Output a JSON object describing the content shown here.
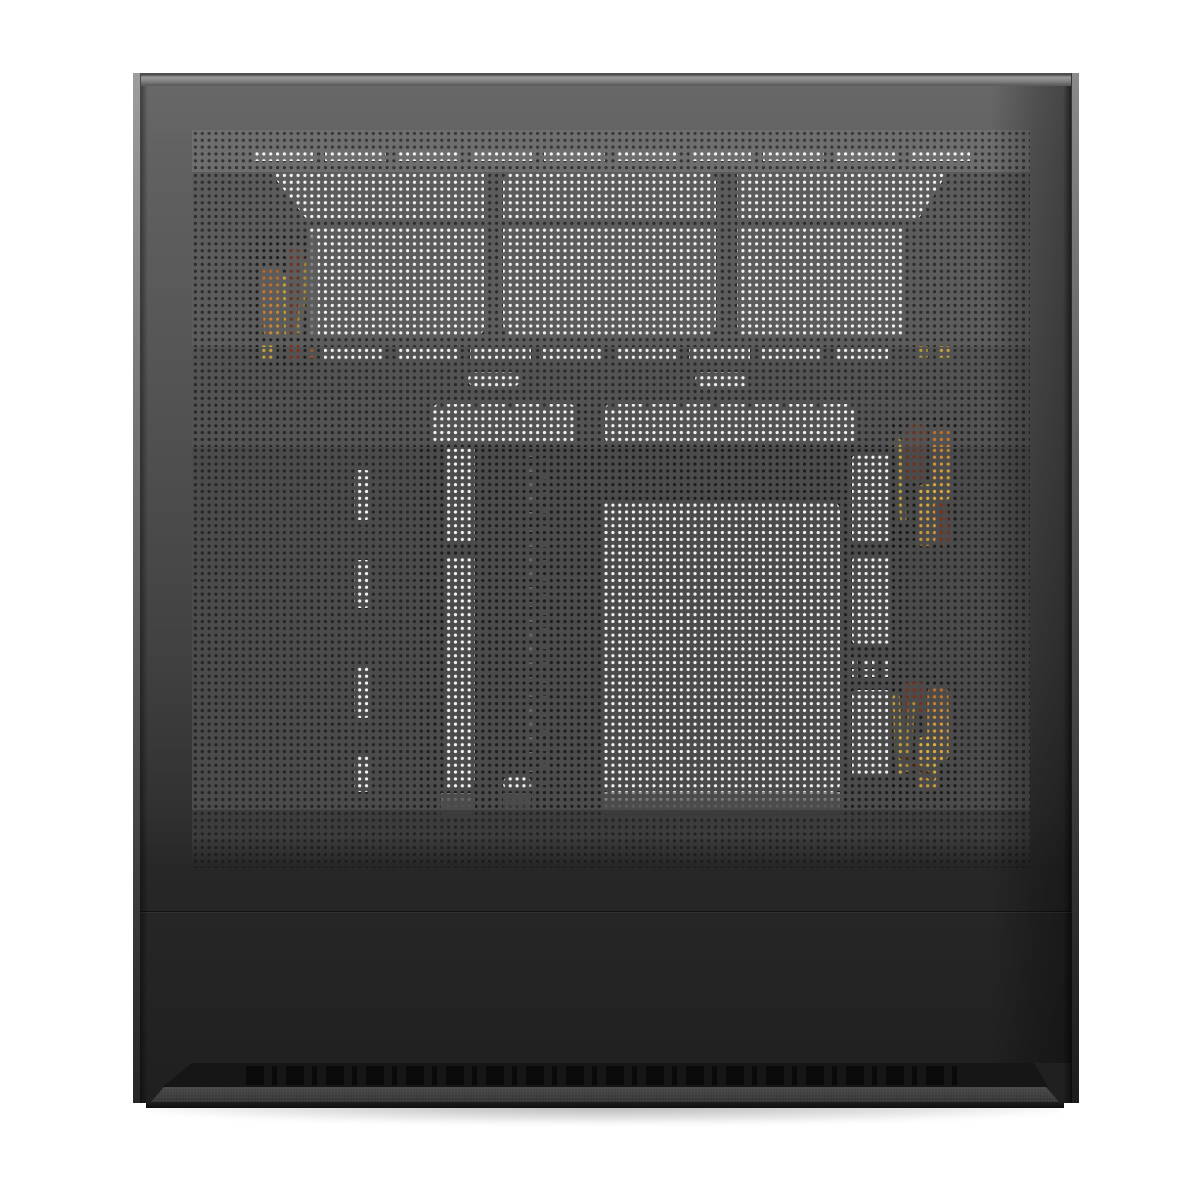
{
  "meta": {
    "description": "Product photograph of a black mid-tower PC case shown from its perforated mesh side panel. White cutouts (three top fan openings, slotted vent rows, motherboard-tray and GPU ventilation cutouts) and orange/yellow PSU cables are visible through the mesh. A slotted intake vent and textured base run along the bottom.",
    "visible_text": ""
  },
  "palette": {
    "page-bg": "#ffffff",
    "edge-light": "#9a9a9a",
    "frame-top": "#686868",
    "frame-bottom": "#1f1f1f",
    "mesh-top": "#6e6e6e",
    "mesh-fan": "#5c5c5c",
    "mesh-mid": "#535353",
    "mesh-low": "#4b4b4b",
    "mesh-bot": "#3c3c3c",
    "int-top": "#3a3a3a",
    "int-base": "#262626",
    "int-dark": "#1d1d1d",
    "cutout-white": "#f3f3f3",
    "ghost-grey": "#8a8a8a",
    "cable-orange": "#c9792e",
    "cable-amber": "#d79a3a",
    "cable-yellow": "#c9a43a",
    "cable-brown": "#6b3220",
    "cable-darkred": "#7c2f1a",
    "vent-black": "#0a0a0a",
    "base-grey": "#3e3e3e",
    "shadow": "rgba(0,0,0,0.30)"
  },
  "scene": {
    "object": "pc-case-mesh-side-panel",
    "fan_cutouts": 3,
    "top_slot_rows": 2,
    "tray_cutouts": 4,
    "cable_bundles": 3
  }
}
